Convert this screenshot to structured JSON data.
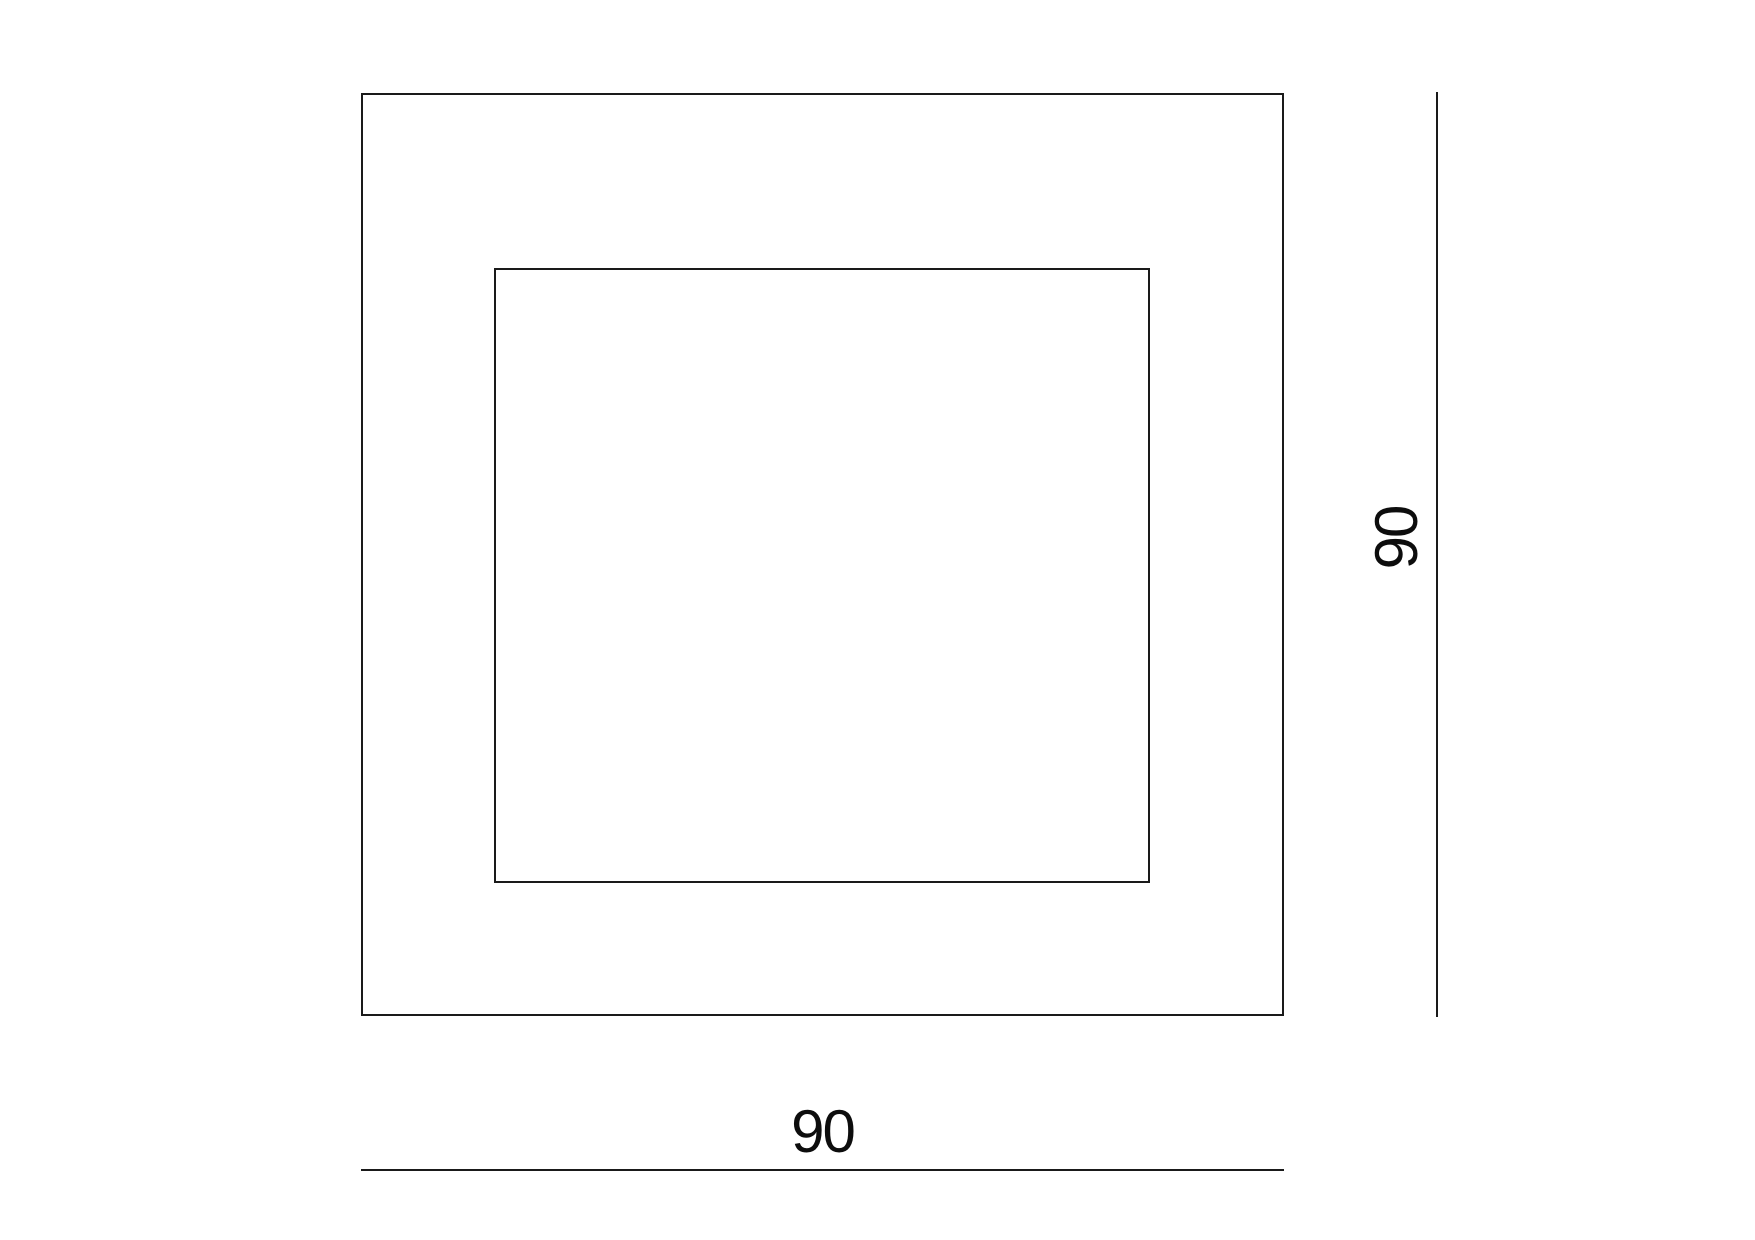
{
  "diagram": {
    "type": "technical-dimension-drawing",
    "background_color": "#ffffff",
    "line_color": "#1a1a1a",
    "text_color": "#0d0d0d",
    "shapes": [
      {
        "name": "outer-square",
        "kind": "square-outline"
      },
      {
        "name": "inner-square",
        "kind": "square-outline"
      }
    ],
    "dimensions": {
      "width": {
        "value": "90",
        "orientation": "horizontal",
        "position": "bottom"
      },
      "height": {
        "value": "90",
        "orientation": "vertical",
        "position": "right"
      }
    }
  }
}
